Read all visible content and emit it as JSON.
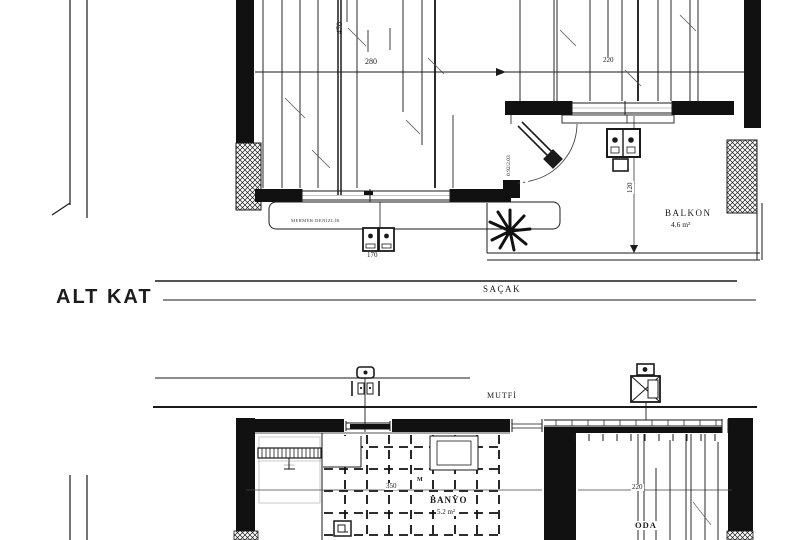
{
  "meta": {
    "drawing_type": "architectural floor plan",
    "floor_title": "ALT KAT"
  },
  "labels": {
    "sacak": "SAÇAK",
    "mutfak": "MUTFİ",
    "balkon": "BALKON",
    "balkon_area": "4.6 m²",
    "banyo": "BANYO",
    "banyo_area": "5.2 m²",
    "oda": "ODA",
    "sill": "MERMER DENİZLİK",
    "marker_m": "M"
  },
  "dimensions": {
    "upper_span_left": "280",
    "upper_span_right": "220",
    "upper_vertical": "470",
    "door_size": "0.92/2.03",
    "appliance_width": "170",
    "balcony_depth": "120",
    "banyo_width": "350",
    "oda_width": "220"
  },
  "colors": {
    "ink": "#1a1a1a",
    "faint_line": "#c2c2c2",
    "background": "#ffffff"
  },
  "icons": [
    "plant-icon",
    "stove-icon",
    "radiator-icon",
    "valve-icon",
    "water-heater-icon",
    "floor-drain-icon",
    "door-swing-icon",
    "column-hatch-icon"
  ]
}
